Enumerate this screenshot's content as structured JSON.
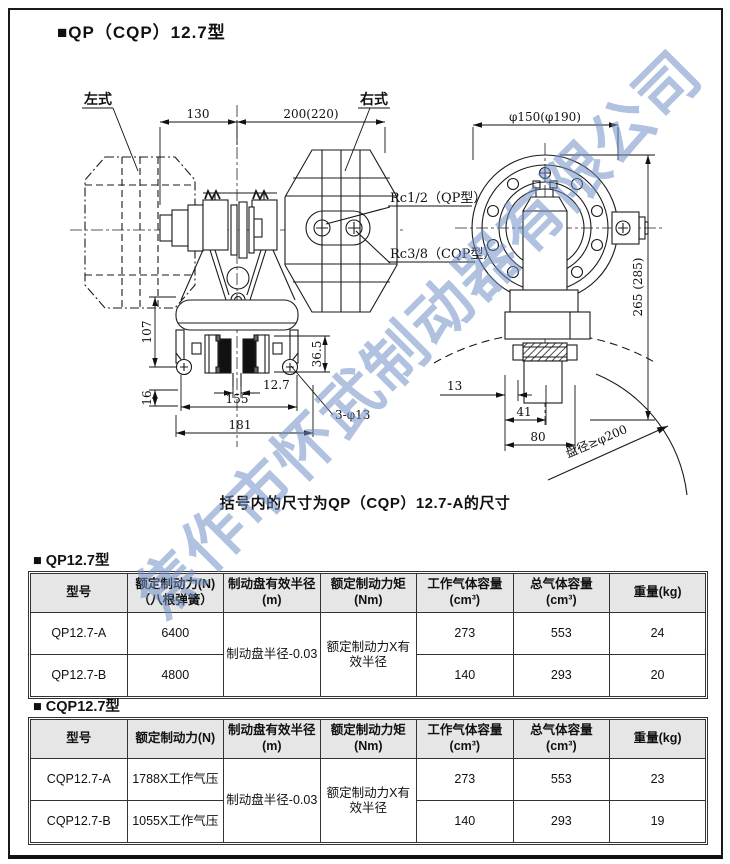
{
  "page": {
    "title": "■QP（CQP）12.7型",
    "caption": "括号内的尺寸为QP（CQP）12.7-A的尺寸",
    "watermark": "焦作市怀武制动器有限公司"
  },
  "drawing": {
    "labels": {
      "left_type": "左式",
      "right_type": "右式",
      "rc_qp": "Rc1/2（QP型）",
      "rc_cqp": "Rc3/8（CQP型）",
      "disc_dia": "盘径≥φ200"
    },
    "dims": {
      "w130": "130",
      "w200": "200(220)",
      "dia_top": "φ150(φ190)",
      "h265": "265 (285)",
      "h107": "107",
      "h16": "16",
      "h365": "36.5",
      "t127": "12.7",
      "w155": "155",
      "w181": "181",
      "holes": "3-φ13",
      "o13": "13",
      "o41": "41",
      "o80": "80"
    }
  },
  "tables": [
    {
      "section_title": "■ QP12.7型",
      "headers": [
        "型号",
        "额定制动力(N)\n（八根弹簧）",
        "制动盘有效半径\n(m)",
        "额定制动力矩\n(Nm)",
        "工作气体容量\n(cm³)",
        "总气体容量\n(cm³)",
        "重量(kg)"
      ],
      "merged": {
        "radius": "制动盘半径-0.03",
        "torque": "额定制动力X有效半径"
      },
      "rows": [
        {
          "model": "QP12.7-A",
          "force": "6400",
          "work": "273",
          "total": "553",
          "weight": "24"
        },
        {
          "model": "QP12.7-B",
          "force": "4800",
          "work": "140",
          "total": "293",
          "weight": "20"
        }
      ]
    },
    {
      "section_title": "■ CQP12.7型",
      "headers": [
        "型号",
        "额定制动力(N)",
        "制动盘有效半径\n(m)",
        "额定制动力矩\n(Nm)",
        "工作气体容量\n(cm³)",
        "总气体容量\n(cm³)",
        "重量(kg)"
      ],
      "merged": {
        "radius": "制动盘半径-0.03",
        "torque": "额定制动力X有效半径"
      },
      "rows": [
        {
          "model": "CQP12.7-A",
          "force": "1788X工作气压",
          "work": "273",
          "total": "553",
          "weight": "23"
        },
        {
          "model": "CQP12.7-B",
          "force": "1055X工作气压",
          "work": "140",
          "total": "293",
          "weight": "19"
        }
      ]
    }
  ]
}
